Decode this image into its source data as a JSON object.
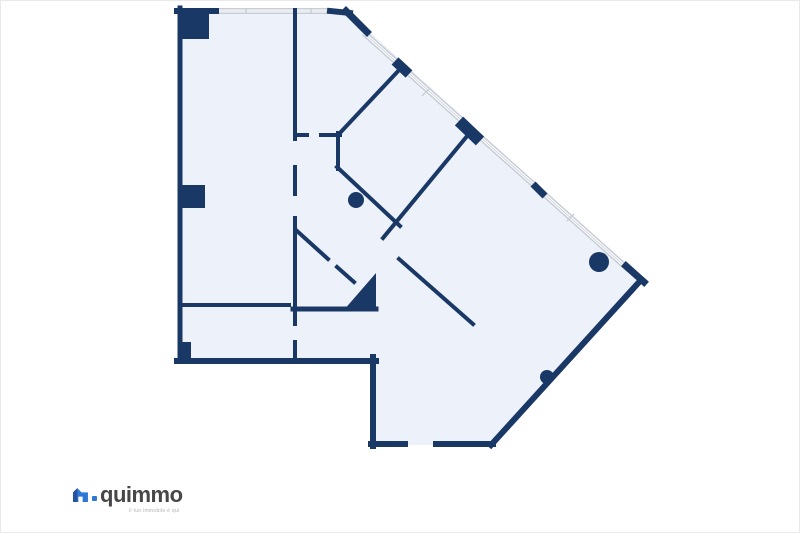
{
  "canvas": {
    "width": 800,
    "height": 533,
    "background": "#ffffff"
  },
  "floorplan": {
    "colors": {
      "floor_fill": "#edf2fa",
      "wall": "#1a3866",
      "window_frame": "#c7ccd6",
      "window_glass": "#ffffff"
    },
    "floor_polygon": "180,10 348,12 641,279 492,445 372,445 372,361 180,361",
    "windows": [
      {
        "x1": 216,
        "y1": 11,
        "x2": 331,
        "y2": 11,
        "w": 6
      },
      {
        "x1": 364,
        "y1": 33,
        "x2": 629,
        "y2": 270,
        "w": 6
      }
    ],
    "window_ticks": [
      {
        "x1": 246,
        "y1": 8,
        "x2": 246,
        "y2": 14
      },
      {
        "x1": 311,
        "y1": 8,
        "x2": 311,
        "y2": 14
      },
      {
        "x1": 422,
        "y1": 96,
        "x2": 429,
        "y2": 89
      },
      {
        "x1": 567,
        "y1": 221,
        "x2": 574,
        "y2": 214
      }
    ],
    "outer_walls": [
      {
        "x1": 180,
        "y1": 8,
        "x2": 180,
        "y2": 361,
        "w": 5
      },
      {
        "x1": 177,
        "y1": 11,
        "x2": 216,
        "y2": 11,
        "w": 6
      },
      {
        "x1": 330,
        "y1": 11,
        "x2": 350,
        "y2": 13,
        "w": 6
      },
      {
        "x1": 346,
        "y1": 11,
        "x2": 367,
        "y2": 32,
        "w": 7
      },
      {
        "x1": 626,
        "y1": 266,
        "x2": 644,
        "y2": 282,
        "w": 7
      },
      {
        "x1": 641,
        "y1": 280,
        "x2": 491,
        "y2": 445,
        "w": 6
      },
      {
        "x1": 371,
        "y1": 444,
        "x2": 405,
        "y2": 444,
        "w": 6
      },
      {
        "x1": 436,
        "y1": 444,
        "x2": 493,
        "y2": 444,
        "w": 6
      },
      {
        "x1": 373,
        "y1": 357,
        "x2": 373,
        "y2": 446,
        "w": 6
      },
      {
        "x1": 177,
        "y1": 361,
        "x2": 376,
        "y2": 361,
        "w": 6
      }
    ],
    "interior_walls": [
      {
        "x1": 295,
        "y1": 10,
        "x2": 295,
        "y2": 139,
        "w": 4
      },
      {
        "x1": 295,
        "y1": 167,
        "x2": 295,
        "y2": 194,
        "w": 4
      },
      {
        "x1": 295,
        "y1": 218,
        "x2": 295,
        "y2": 324,
        "w": 4
      },
      {
        "x1": 295,
        "y1": 342,
        "x2": 295,
        "y2": 360,
        "w": 4
      },
      {
        "x1": 295,
        "y1": 135,
        "x2": 307,
        "y2": 135,
        "w": 4
      },
      {
        "x1": 321,
        "y1": 135,
        "x2": 340,
        "y2": 135,
        "w": 4
      },
      {
        "x1": 338,
        "y1": 135,
        "x2": 401,
        "y2": 68,
        "w": 4
      },
      {
        "x1": 338,
        "y1": 133,
        "x2": 338,
        "y2": 169,
        "w": 4
      },
      {
        "x1": 337,
        "y1": 167,
        "x2": 400,
        "y2": 226,
        "w": 4
      },
      {
        "x1": 468,
        "y1": 135,
        "x2": 383,
        "y2": 238,
        "w": 4
      },
      {
        "x1": 399,
        "y1": 259,
        "x2": 473,
        "y2": 324,
        "w": 4
      },
      {
        "x1": 297,
        "y1": 231,
        "x2": 328,
        "y2": 259,
        "w": 4
      },
      {
        "x1": 337,
        "y1": 267,
        "x2": 354,
        "y2": 282,
        "w": 4
      },
      {
        "x1": 180,
        "y1": 305,
        "x2": 289,
        "y2": 305,
        "w": 4
      },
      {
        "x1": 293,
        "y1": 309,
        "x2": 376,
        "y2": 309,
        "w": 5
      }
    ],
    "wall_marks": [
      {
        "x1": 395,
        "y1": 61,
        "x2": 409,
        "y2": 74,
        "w": 10
      },
      {
        "x1": 459,
        "y1": 121,
        "x2": 480,
        "y2": 141,
        "w": 12
      },
      {
        "x1": 533,
        "y1": 184,
        "x2": 545,
        "y2": 196,
        "w": 7
      }
    ],
    "columns": [
      {
        "x": 181,
        "y": 10,
        "w": 28,
        "h": 29
      },
      {
        "x": 181,
        "y": 185,
        "w": 24,
        "h": 23
      },
      {
        "x": 180,
        "y": 342,
        "w": 11,
        "h": 17
      }
    ],
    "solid_polygons": [
      "343,311 376,273 376,311"
    ],
    "circles": [
      {
        "cx": 356,
        "cy": 200,
        "r": 8
      },
      {
        "cx": 599,
        "cy": 262,
        "r": 10
      },
      {
        "cx": 547,
        "cy": 377,
        "r": 7
      }
    ]
  },
  "logo": {
    "brand": "quimmo",
    "tagline": "il tuo immobile è qui",
    "brand_color": "#474747",
    "tagline_color": "#b2b2b2",
    "icon_blue": "#2e77d4",
    "icon_navy": "#24549b",
    "dot_color": "#2e77d4"
  }
}
